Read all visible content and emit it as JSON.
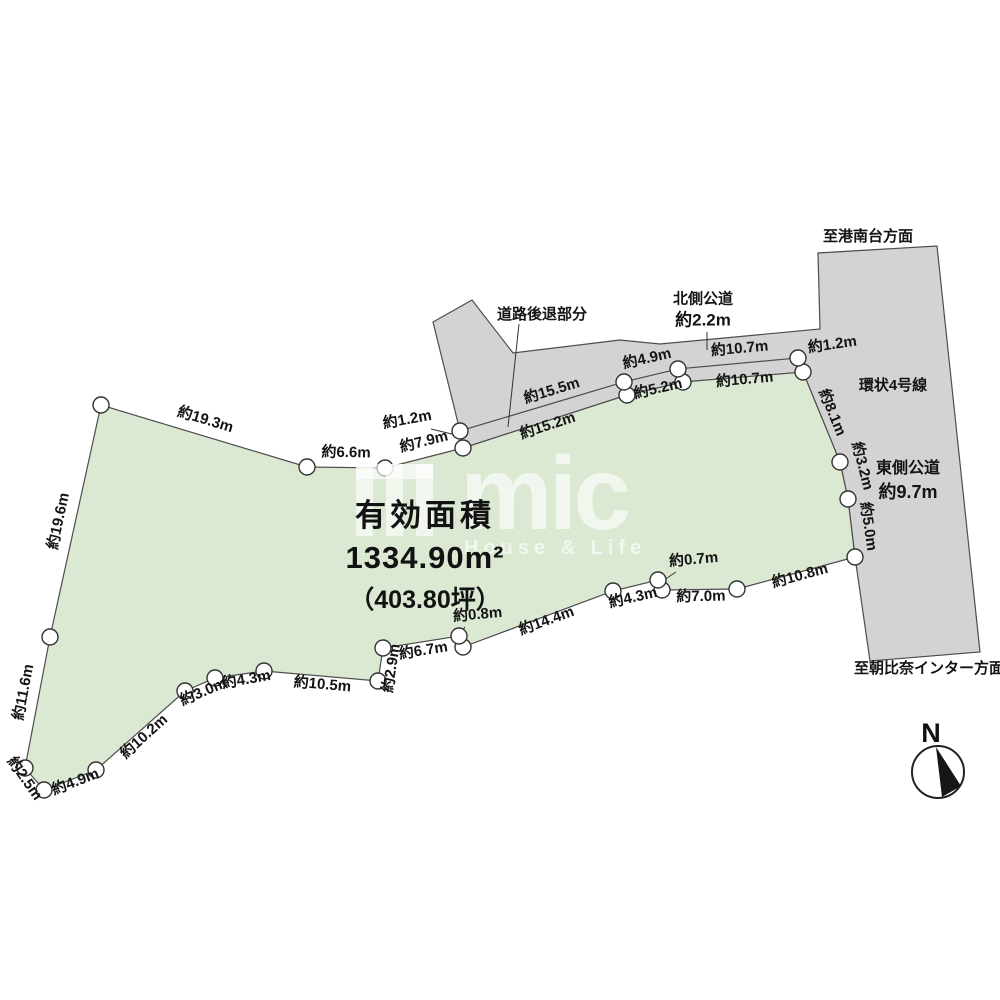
{
  "title_block": {
    "label": "有効面積",
    "area_m2": "1334.90m²",
    "area_tsubo": "（403.80坪）"
  },
  "roads": {
    "setback_label": "道路後退部分",
    "north_road_name": "北側公道",
    "north_road_width": "約2.2m",
    "ring_road_name": "環状4号線",
    "east_road_name": "東側公道",
    "east_road_width": "約9.7m",
    "direction_top": "至港南台方面",
    "direction_bottom": "至朝比奈インター方面"
  },
  "compass": {
    "label": "N"
  },
  "watermark": {
    "logo_text": "mic",
    "tagline": "House & Life"
  },
  "colors": {
    "plot_fill": "#dbe9d3",
    "road_fill": "#d3d3d3",
    "outline": "#4d4d4d"
  },
  "dimension_labels": [
    {
      "text": "約19.3m",
      "x": 204,
      "y": 424,
      "rot": 17
    },
    {
      "text": "約6.6m",
      "x": 346,
      "y": 457,
      "rot": 1
    },
    {
      "text": "約7.9m",
      "x": 425,
      "y": 446,
      "rot": -14
    },
    {
      "text": "約1.2m",
      "x": 408,
      "y": 424,
      "rot": -10
    },
    {
      "text": "約15.5m",
      "x": 553,
      "y": 395,
      "rot": -17
    },
    {
      "text": "約15.2m",
      "x": 549,
      "y": 430,
      "rot": -18
    },
    {
      "text": "約4.9m",
      "x": 648,
      "y": 363,
      "rot": -13
    },
    {
      "text": "約5.2m",
      "x": 659,
      "y": 393,
      "rot": -13
    },
    {
      "text": "約10.7m",
      "x": 740,
      "y": 353,
      "rot": -5
    },
    {
      "text": "約10.7m",
      "x": 745,
      "y": 384,
      "rot": -5
    },
    {
      "text": "約1.2m",
      "x": 833,
      "y": 349,
      "rot": -8
    },
    {
      "text": "約8.1m",
      "x": 828,
      "y": 414,
      "rot": 68
    },
    {
      "text": "約3.2m",
      "x": 858,
      "y": 467,
      "rot": 76
    },
    {
      "text": "約5.0m",
      "x": 864,
      "y": 527,
      "rot": 82
    },
    {
      "text": "約10.8m",
      "x": 801,
      "y": 580,
      "rot": -15
    },
    {
      "text": "約7.0m",
      "x": 701,
      "y": 601,
      "rot": -1
    },
    {
      "text": "約0.7m",
      "x": 694,
      "y": 564,
      "rot": -5
    },
    {
      "text": "約4.3m",
      "x": 634,
      "y": 602,
      "rot": -13
    },
    {
      "text": "約14.4m",
      "x": 548,
      "y": 625,
      "rot": -20
    },
    {
      "text": "約0.8m",
      "x": 478,
      "y": 619,
      "rot": -5
    },
    {
      "text": "約6.7m",
      "x": 424,
      "y": 655,
      "rot": -9
    },
    {
      "text": "約2.9m",
      "x": 396,
      "y": 669,
      "rot": -81
    },
    {
      "text": "約10.5m",
      "x": 322,
      "y": 689,
      "rot": 5
    },
    {
      "text": "約4.3m",
      "x": 247,
      "y": 684,
      "rot": -10
    },
    {
      "text": "約3.0m",
      "x": 205,
      "y": 696,
      "rot": -23
    },
    {
      "text": "約10.2m",
      "x": 147,
      "y": 740,
      "rot": -42
    },
    {
      "text": "約4.9m",
      "x": 77,
      "y": 786,
      "rot": -21
    },
    {
      "text": "約2.5m",
      "x": 21,
      "y": 781,
      "rot": 55
    },
    {
      "text": "約11.6m",
      "x": 28,
      "y": 693,
      "rot": -79
    },
    {
      "text": "約19.6m",
      "x": 63,
      "y": 522,
      "rot": -78
    }
  ]
}
